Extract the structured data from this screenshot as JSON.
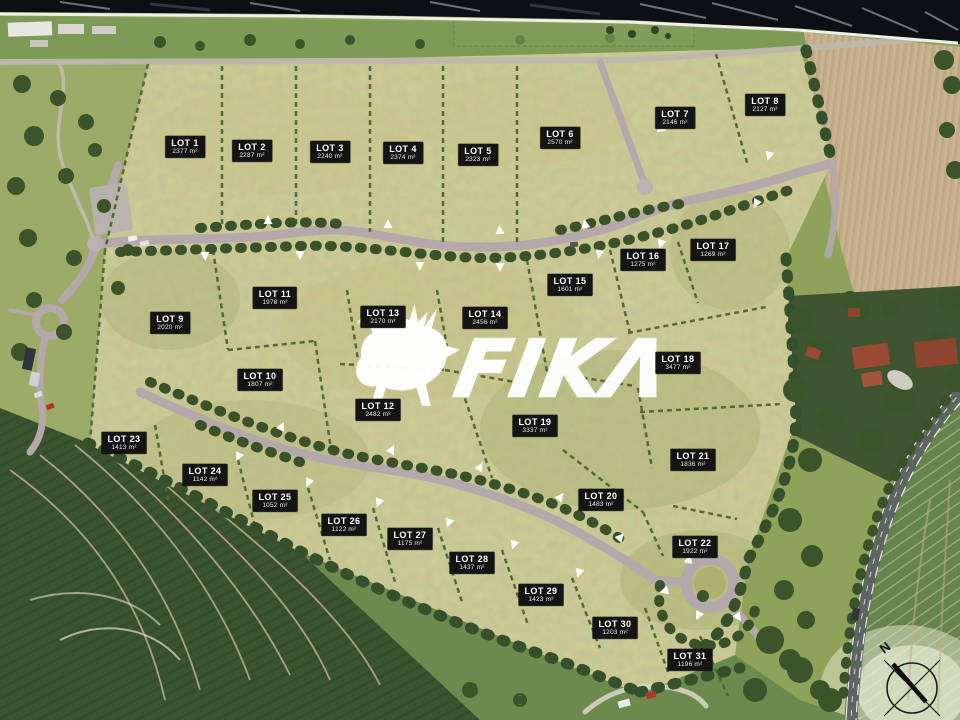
{
  "palette": {
    "label-bg": "#141414",
    "label-text": "#ffffff",
    "grass": "#b0b073",
    "road": "#b4a8ab",
    "hedge": "#4f6533"
  },
  "watermark": {
    "brand": "FIKA",
    "display": "FIKΛ"
  },
  "compass": {
    "label": "N"
  },
  "lots": [
    {
      "name": "LOT 1",
      "area": "2377 m²",
      "x": 185,
      "y": 147
    },
    {
      "name": "LOT 2",
      "area": "2287 m²",
      "x": 252,
      "y": 151
    },
    {
      "name": "LOT 3",
      "area": "2240 m²",
      "x": 330,
      "y": 152
    },
    {
      "name": "LOT 4",
      "area": "2374 m²",
      "x": 403,
      "y": 153
    },
    {
      "name": "LOT 5",
      "area": "2323 m²",
      "x": 478,
      "y": 155
    },
    {
      "name": "LOT 6",
      "area": "2570 m²",
      "x": 560,
      "y": 138
    },
    {
      "name": "LOT 7",
      "area": "2146 m²",
      "x": 675,
      "y": 118
    },
    {
      "name": "LOT 8",
      "area": "2127 m²",
      "x": 765,
      "y": 105
    },
    {
      "name": "LOT 9",
      "area": "2020 m²",
      "x": 170,
      "y": 323
    },
    {
      "name": "LOT 10",
      "area": "1807 m²",
      "x": 260,
      "y": 380
    },
    {
      "name": "LOT 11",
      "area": "1978 m²",
      "x": 275,
      "y": 298
    },
    {
      "name": "LOT 12",
      "area": "2482 m²",
      "x": 378,
      "y": 410
    },
    {
      "name": "LOT 13",
      "area": "2170 m²",
      "x": 383,
      "y": 317
    },
    {
      "name": "LOT 14",
      "area": "2456 m²",
      "x": 485,
      "y": 318
    },
    {
      "name": "LOT 15",
      "area": "1601 m²",
      "x": 570,
      "y": 285
    },
    {
      "name": "LOT 16",
      "area": "1275 m²",
      "x": 643,
      "y": 260
    },
    {
      "name": "LOT 17",
      "area": "1269 m²",
      "x": 713,
      "y": 250
    },
    {
      "name": "LOT 18",
      "area": "3477 m²",
      "x": 678,
      "y": 363
    },
    {
      "name": "LOT 19",
      "area": "3337 m²",
      "x": 535,
      "y": 426
    },
    {
      "name": "LOT 20",
      "area": "1483 m²",
      "x": 601,
      "y": 500
    },
    {
      "name": "LOT 21",
      "area": "1836 m²",
      "x": 693,
      "y": 460
    },
    {
      "name": "LOT 22",
      "area": "1922 m²",
      "x": 695,
      "y": 547
    },
    {
      "name": "LOT 23",
      "area": "1413 m²",
      "x": 124,
      "y": 443
    },
    {
      "name": "LOT 24",
      "area": "1142 m²",
      "x": 205,
      "y": 475
    },
    {
      "name": "LOT 25",
      "area": "1052 m²",
      "x": 275,
      "y": 501
    },
    {
      "name": "LOT 26",
      "area": "1122 m²",
      "x": 344,
      "y": 525
    },
    {
      "name": "LOT 27",
      "area": "1175 m²",
      "x": 410,
      "y": 539
    },
    {
      "name": "LOT 28",
      "area": "1437 m²",
      "x": 472,
      "y": 563
    },
    {
      "name": "LOT 29",
      "area": "1423 m²",
      "x": 541,
      "y": 595
    },
    {
      "name": "LOT 30",
      "area": "1203 m²",
      "x": 615,
      "y": 628
    },
    {
      "name": "LOT 31",
      "area": "1196 m²",
      "x": 690,
      "y": 660
    }
  ]
}
